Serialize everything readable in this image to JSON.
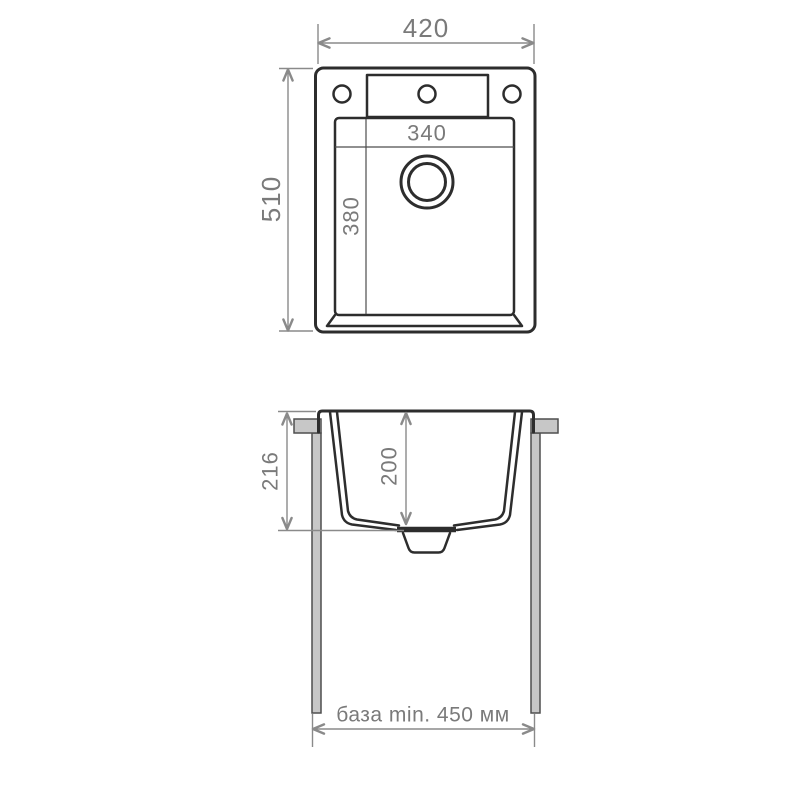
{
  "diagram": {
    "top_view": {
      "overall_width_mm": "420",
      "overall_depth_mm": "510",
      "bowl_width_mm": "340",
      "bowl_depth_mm": "380"
    },
    "side_view": {
      "overall_height_mm": "216",
      "bowl_depth_mm": "200",
      "cabinet_base_label": "база min. 450 мм"
    }
  },
  "colors": {
    "outline": "#2d2d2d",
    "inner-line": "#4d4d4d",
    "dimension": "#8a8a8a",
    "dimension-text": "#7a7a7a",
    "panel-fill": "#c7c7c7",
    "panel-stroke": "#4f4f4f",
    "background": "#ffffff"
  }
}
